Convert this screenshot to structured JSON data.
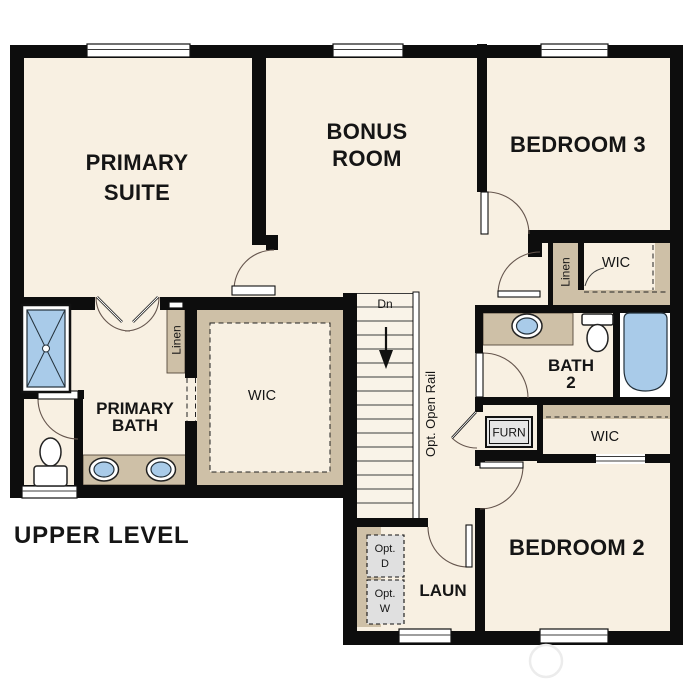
{
  "title": "UPPER LEVEL",
  "rooms": {
    "primary_suite": [
      "PRIMARY",
      "SUITE"
    ],
    "bonus_room": [
      "BONUS",
      "ROOM"
    ],
    "bedroom3": "BEDROOM 3",
    "bedroom2": "BEDROOM 2",
    "primary_bath": [
      "PRIMARY",
      "BATH"
    ],
    "bath2": [
      "BATH",
      "2"
    ],
    "laundry": "LAUN"
  },
  "closets": {
    "wic": "WIC",
    "linen": "Linen",
    "furnace": "FURN"
  },
  "annotations": {
    "down": "Dn",
    "open_rail": "Opt. Open Rail",
    "opt": "Opt.",
    "dryer": "D",
    "washer": "W"
  },
  "colors": {
    "floor": "#f8f0e2",
    "wall": "#0d0d0d",
    "casework": "#cec0a7",
    "fixture_blue": "#a9cbe9",
    "option_gray": "#e0e0e0"
  }
}
